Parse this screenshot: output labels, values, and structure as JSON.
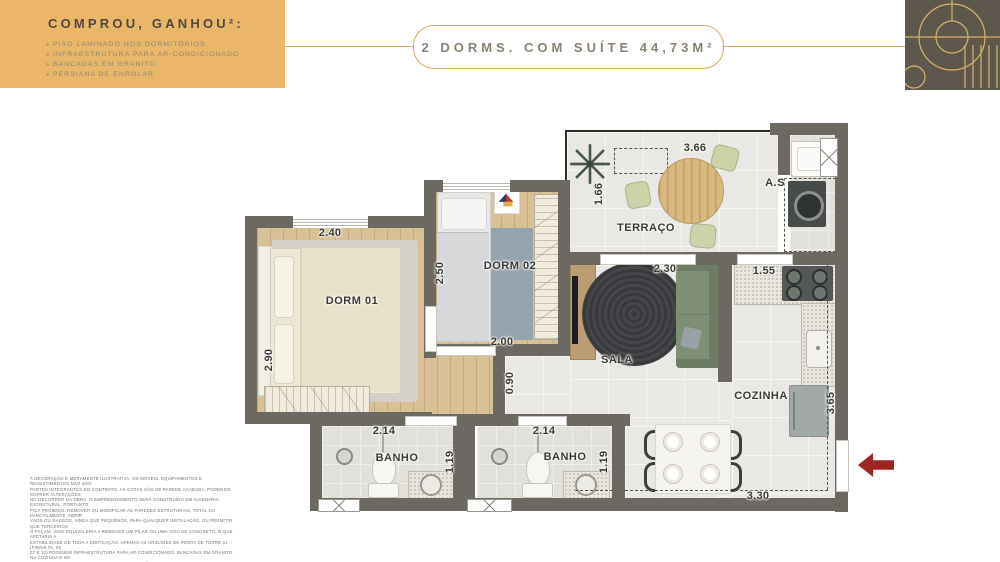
{
  "colors": {
    "promo_bg": "#eab668",
    "accent_gold": "#d2ab62",
    "wall": "#6c6862",
    "arrow_red": "#9e2620",
    "logo_bg": "#5d574e"
  },
  "promo": {
    "title": "COMPROU, GANHOU²:",
    "items": [
      "PISO LAMINADO NOS DORMITÓRIOS",
      "INFRAESTRUTURA PARA AR-CONDICIONADO",
      "BANCADAS EM GRANITO",
      "PERSIANA DE ENROLAR"
    ]
  },
  "header": {
    "title": "2 DORMS. COM SUÍTE 44,73M²"
  },
  "plan": {
    "labels": {
      "dorm01": "DORM 01",
      "dorm02": "DORM 02",
      "terraco": "TERRAÇO",
      "sala": "SALA",
      "cozinha": "COZINHA",
      "banho": "BANHO",
      "as": "A.S"
    },
    "dims": {
      "dorm01_w": "2.40",
      "dorm01_h": "2.90",
      "dorm02_w": "2.00",
      "dorm02_h": "2.50",
      "hall_w": "0.90",
      "terraco_w": "3.66",
      "terraco_h": "1.66",
      "sala_w": "2.30",
      "cozinha_w": "1.55",
      "cozinha_h": "3.65",
      "banho_w": "2.14",
      "banho_h": "1.19",
      "dining_w": "3.30"
    }
  },
  "disclaimer": {
    "lines": [
      "A DECORAÇÃO É MERAMENTE ILUSTRATIVA. OS MÓVEIS, EQUIPAMENTOS E REVESTIMENTOS NÃO SÃO",
      "PARTES INTEGRANTES DO CONTRATO. AS COTAS SÃO DE PAREDE ACABADA, PODENDO SOFRER ALTERAÇÕES",
      "NO DECORRER DA OBRA. O EMPREENDIMENTO SERÁ CONSTRUÍDO EM ALVENARIA ESTRUTURAL, PORTANTO",
      "FICA PROIBIDO: REMOVER OU MODIFICAR AS PAREDES ESTRUTURAIS, TOTAL OU PARCIALMENTE; ABRIR",
      "VÃOS OU RASGOS, AINDA QUE PEQUENOS, PARA QUALQUER INSTALAÇÃO, OU PERMITIR QUE TERCEIROS",
      "O FAÇAM. ISSO EQUIVALERIA A REMOVER UM PILAR OU UMA VIGA DE CONCRETO, O QUE AFETARIA A",
      "ESTABILIDADE DE TODA A EDIFICAÇÃO. APENAS AS UNIDADES DE PONTA DE TORRE 01 (FINAIS 01, 06,",
      "07 E 12) POSSUEM INFRAESTRUTURA PARA AR-CONDICIONADO. BANCADAS EM GRANITO NA COZINHA E NO",
      "BANHEIRO E PERSIANA DE ENROLAR NOS DORMITÓRIOS. *CONFIRA O MEMORIAL DESCRITIVO DO CLIENTE",
      "PARA MAIS INFORMAÇÕES."
    ]
  }
}
